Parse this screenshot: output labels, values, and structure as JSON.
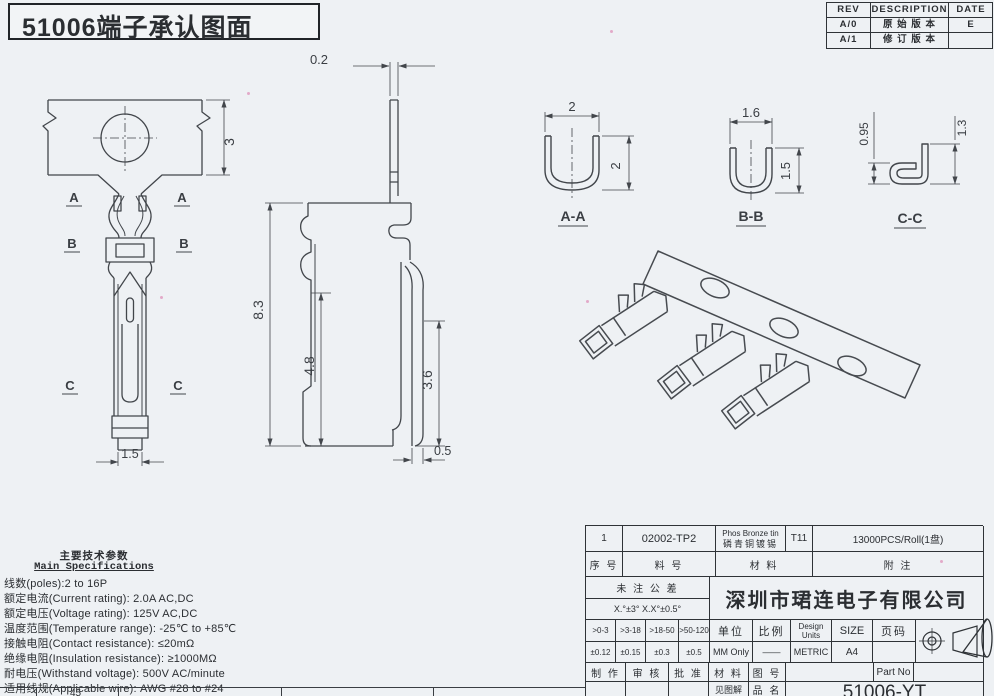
{
  "sheet": {
    "title": "51006端子承认图面"
  },
  "revision": {
    "headers": [
      "REV",
      "DESCRIPTION",
      "DATE"
    ],
    "rows": [
      {
        "rev": "A/0",
        "desc": "原 始 版 本",
        "date": "E"
      },
      {
        "rev": "A/1",
        "desc": "修 订 版 本",
        "date": ""
      }
    ]
  },
  "views": {
    "front": {
      "dim_strip": "3",
      "dim_tip": "1.5",
      "label_a": "A",
      "label_b": "B",
      "label_c": "C"
    },
    "side": {
      "dim_thickness": "0.2",
      "dim_total": "8.3",
      "dim_mid": "4.8",
      "dim_spring": "3.6",
      "dim_foot": "0.5"
    },
    "section_aa": {
      "name": "A-A",
      "dim_w": "2",
      "dim_h": "2"
    },
    "section_bb": {
      "name": "B-B",
      "dim_w": "1.6",
      "dim_h": "1.5"
    },
    "section_cc": {
      "name": "C-C",
      "dim_l": "0.95",
      "dim_r": "1.3"
    }
  },
  "specs": {
    "title_cn": "主要技术参数",
    "title_en": "Main Specifications",
    "items": [
      "线数(poles):2 to 16P",
      "额定电流(Current rating): 2.0A AC,DC",
      "额定电压(Voltage rating): 125V AC,DC",
      "温度范围(Temperature range): -25℃ to +85℃",
      "接触电阻(Contact resistance): ≤20mΩ",
      "绝缘电阻(Insulation resistance): ≥1000MΩ",
      "耐电压(Withstand voltage): 500V AC/minute",
      "适用线规(Applicable wire): AWG #28 to #24"
    ]
  },
  "strip_table_fragment": {
    "visible_cell": "45"
  },
  "title_block": {
    "row1": {
      "no": "1",
      "part": "02002-TP2",
      "material_en": "Phos Bronze tin",
      "material_cn": "磷青铜镀锡",
      "grade": "T11",
      "note": "13000PCS/Roll(1盘)"
    },
    "row2": {
      "no": "序 号",
      "part": "料  号",
      "material": "材  料",
      "note": "附  注"
    },
    "untoleranced": "未 注 公 差",
    "angle_tol": "X.°±3°  X.X°±0.5°",
    "company": "深圳市珺连电子有限公司",
    "tol_headers": [
      ">0-3",
      ">3-18",
      ">18-50",
      ">50-120"
    ],
    "tol_values": [
      "±0.12",
      "±0.15",
      "±0.3",
      "±0.5"
    ],
    "unit_label": "单位",
    "unit_value": "MM Only",
    "scale_label": "比例",
    "scale_value": "——",
    "design_label": "Design Units",
    "design_value": "METRIC",
    "size_label": "SIZE",
    "size_value": "A4",
    "page_label": "页码",
    "page_value": "",
    "sign": {
      "make": "制 作",
      "check": "审 核",
      "approve": "批 准",
      "material": "材 料",
      "drawing_no": "图 号",
      "see": "见图解",
      "product": "品 名"
    },
    "part_no_label": "Part No",
    "part_no": "51006-YT"
  }
}
